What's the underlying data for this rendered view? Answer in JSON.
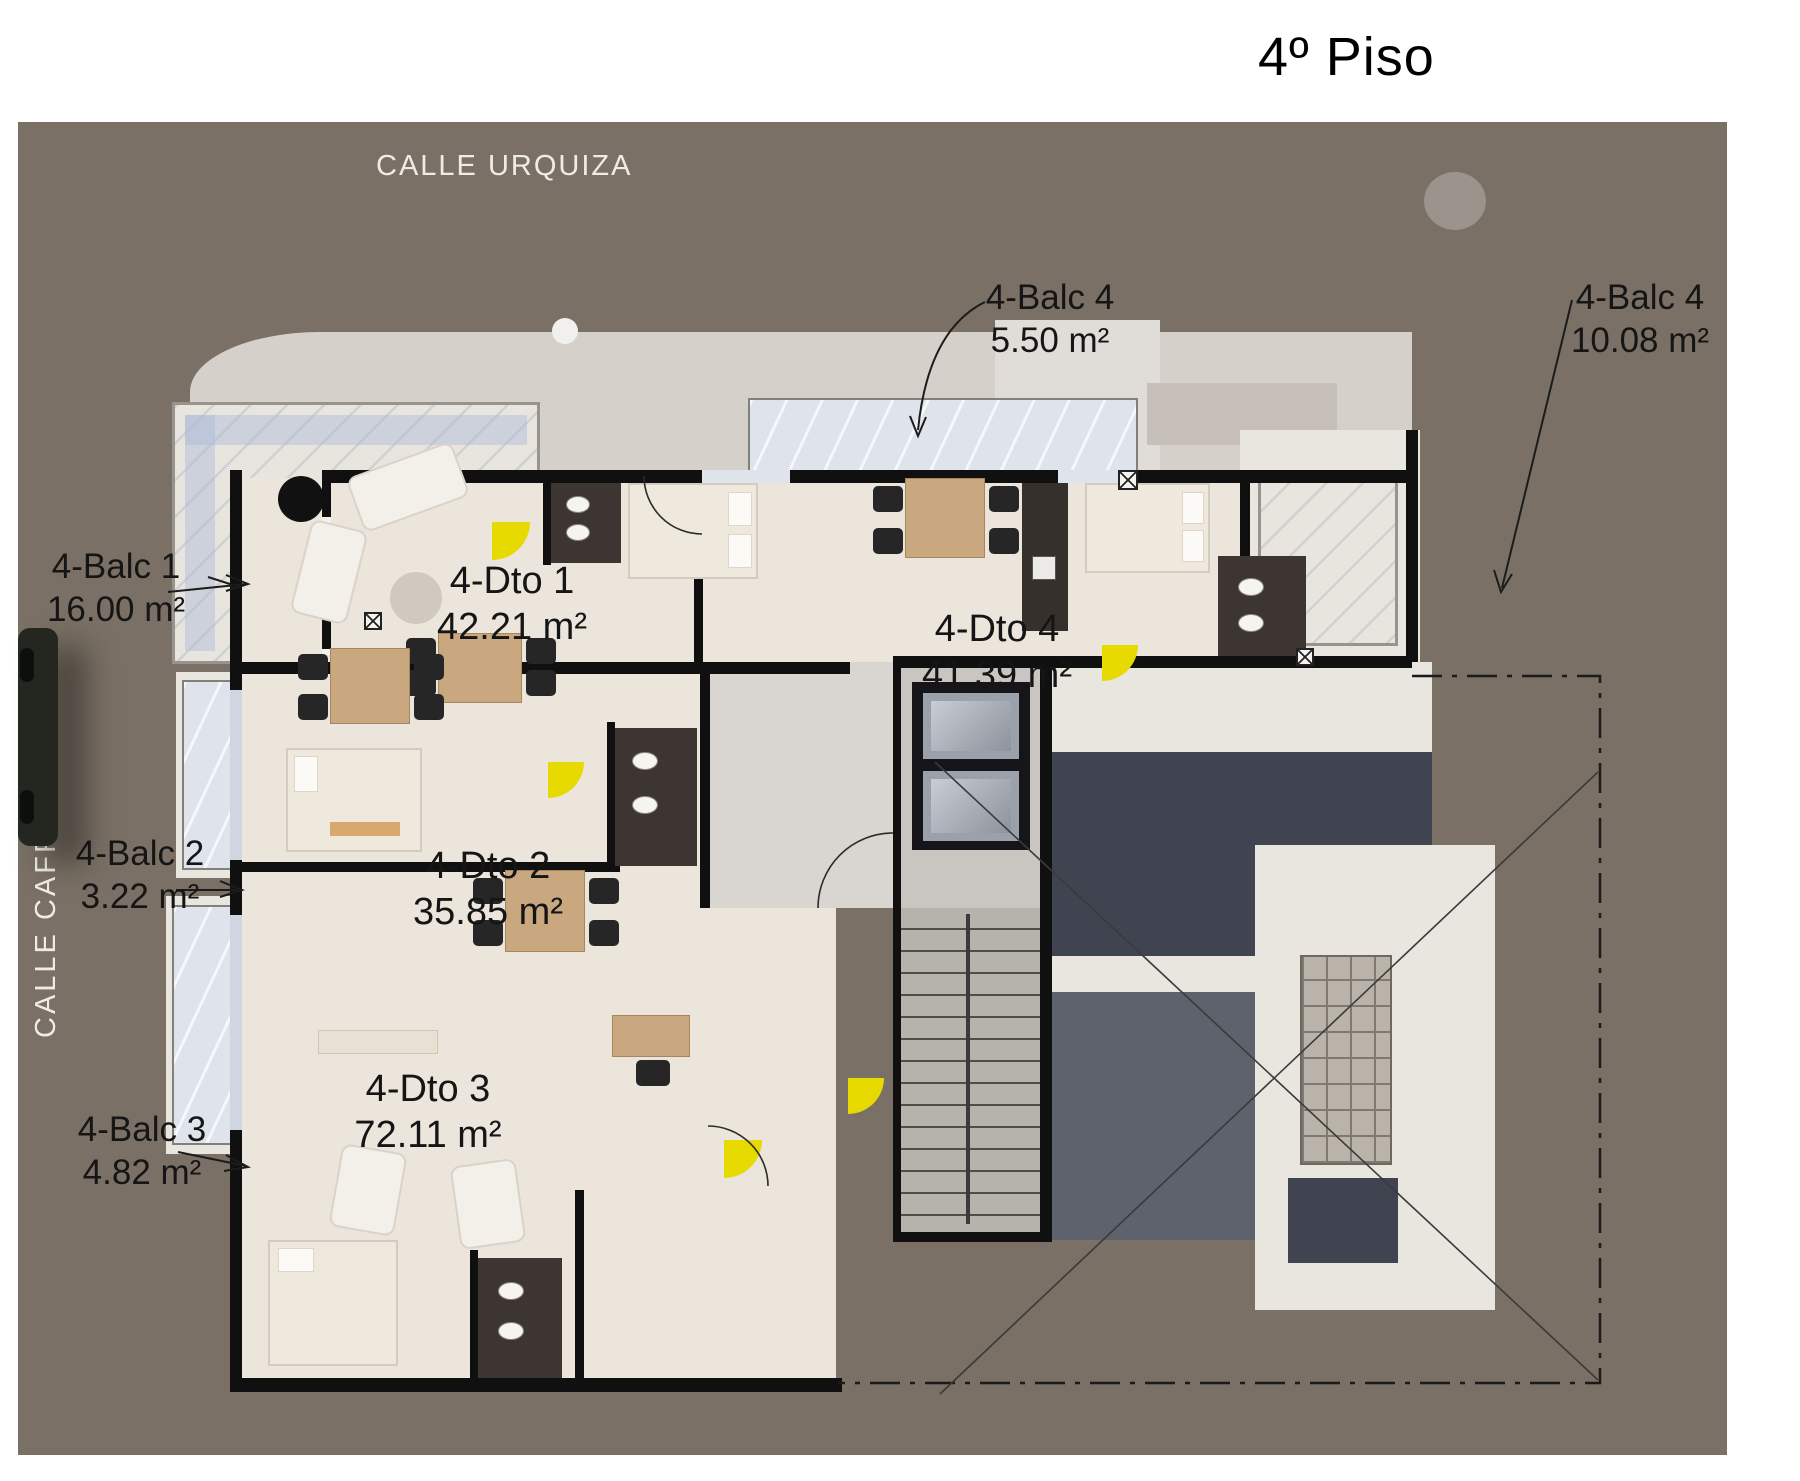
{
  "page": {
    "title": "4º Piso"
  },
  "streets": {
    "top": "CALLE URQUIZA",
    "left": "CALLE CAFFERATA"
  },
  "apartments": [
    {
      "label": "4-Dto 1",
      "area": "42.21 m²"
    },
    {
      "label": "4-Dto 2",
      "area": "35.85 m²"
    },
    {
      "label": "4-Dto 3",
      "area": "72.11 m²"
    },
    {
      "label": "4-Dto 4",
      "area": "41.39 m²"
    }
  ],
  "balconies": [
    {
      "label": "4-Balc 1",
      "area": "16.00 m²"
    },
    {
      "label": "4-Balc 2",
      "area": "3.22 m²"
    },
    {
      "label": "4-Balc 3",
      "area": "4.82 m²"
    },
    {
      "label": "4-Balc 4",
      "area": "5.50 m²"
    },
    {
      "label": "4-Balc 4",
      "area": "10.08 m²"
    }
  ],
  "colors": {
    "street_bg": "#7a7065",
    "floor": "#ebe5dc",
    "wall": "#101010",
    "roof_dark": "#3f4450",
    "roof_light": "#d6d0ca",
    "accent_yellow": "#e6da00",
    "balcony_glass": "#dfe4ec"
  }
}
